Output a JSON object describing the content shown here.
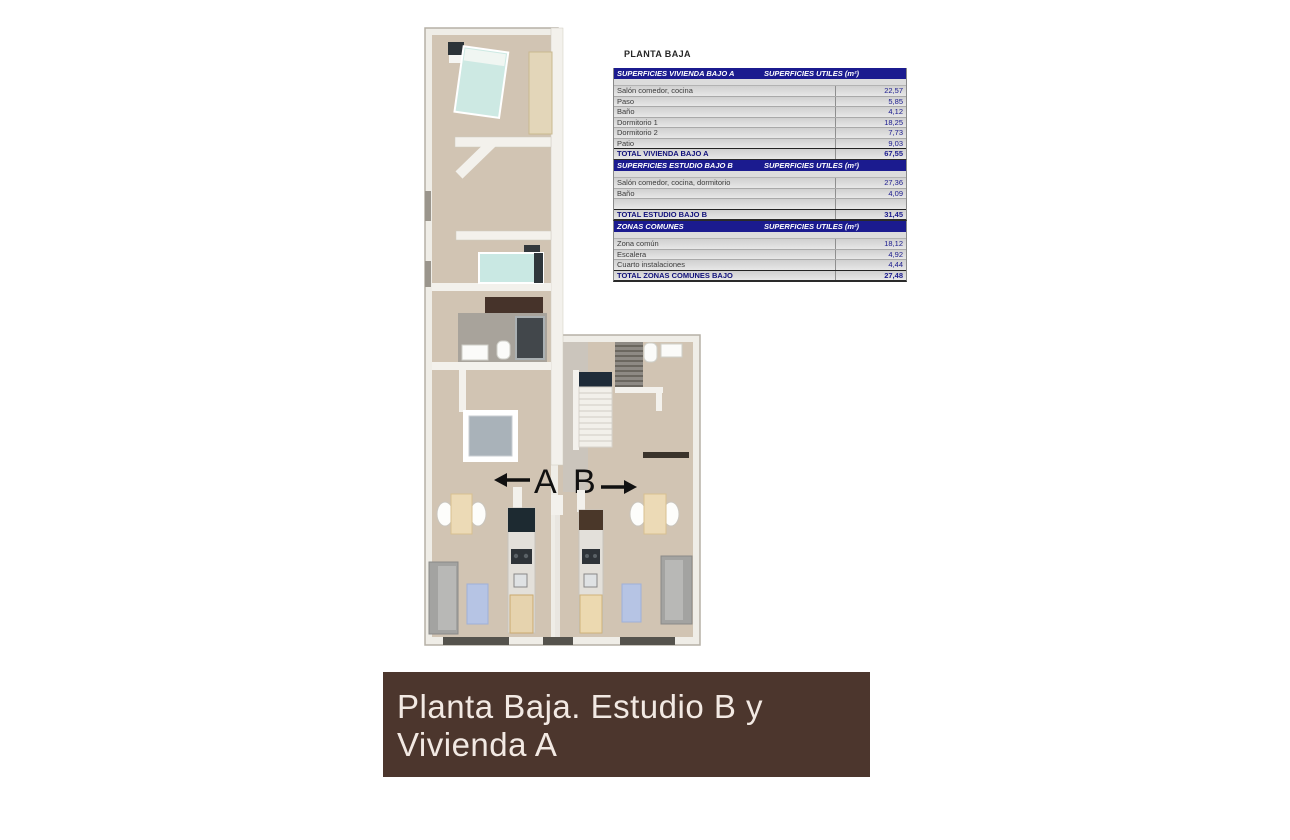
{
  "page": {
    "title": "PLANTA BAJA"
  },
  "tables": [
    {
      "name": "SUPERFICIES VIVIENDA BAJO A",
      "unit_header": "SUPERFICIES UTILES  (m²)",
      "rows": [
        {
          "label": "Salón comedor, cocina",
          "value": "22,57"
        },
        {
          "label": "Paso",
          "value": "5,85"
        },
        {
          "label": "Baño",
          "value": "4,12"
        },
        {
          "label": "Dormitorio 1",
          "value": "18,25"
        },
        {
          "label": "Dormitorio 2",
          "value": "7,73"
        },
        {
          "label": "Patio",
          "value": "9,03"
        }
      ],
      "total": {
        "label": "TOTAL VIVIENDA BAJO A",
        "value": "67,55"
      }
    },
    {
      "name": "SUPERFICIES ESTUDIO BAJO B",
      "unit_header": "SUPERFICIES UTILES  (m²)",
      "rows": [
        {
          "label": "Salón comedor, cocina, dormitorio",
          "value": "27,36"
        },
        {
          "label": "Baño",
          "value": "4,09"
        },
        {
          "label": "",
          "value": ""
        }
      ],
      "total": {
        "label": "TOTAL ESTUDIO BAJO B",
        "value": "31,45"
      }
    },
    {
      "name": "ZONAS COMUNES",
      "unit_header": "SUPERFICIES UTILES  (m²)",
      "rows": [
        {
          "label": "Zona común",
          "value": "18,12"
        },
        {
          "label": "Escalera",
          "value": "4,92"
        },
        {
          "label": "Cuarto instalaciones",
          "value": "4,44"
        }
      ],
      "total": {
        "label": "TOTAL ZONAS COMUNES BAJO",
        "value": "27,48"
      }
    }
  ],
  "plan": {
    "unit_a_label": "A",
    "unit_b_label": "B"
  },
  "banner": {
    "text": "Planta Baja. Estudio B y Vivienda A"
  },
  "colors": {
    "table_header_bg": "#1b1b8f",
    "table_value_text": "#1b1b8f",
    "banner_bg": "#4c362d",
    "banner_text": "#f2e9e3",
    "floor_beige": "#d1c4b3",
    "bathroom_gray": "#a8a39b",
    "bed_teal": "#c9e8e3",
    "rug_blue": "#b6c4e4",
    "wall_white": "#f3f1ec"
  }
}
